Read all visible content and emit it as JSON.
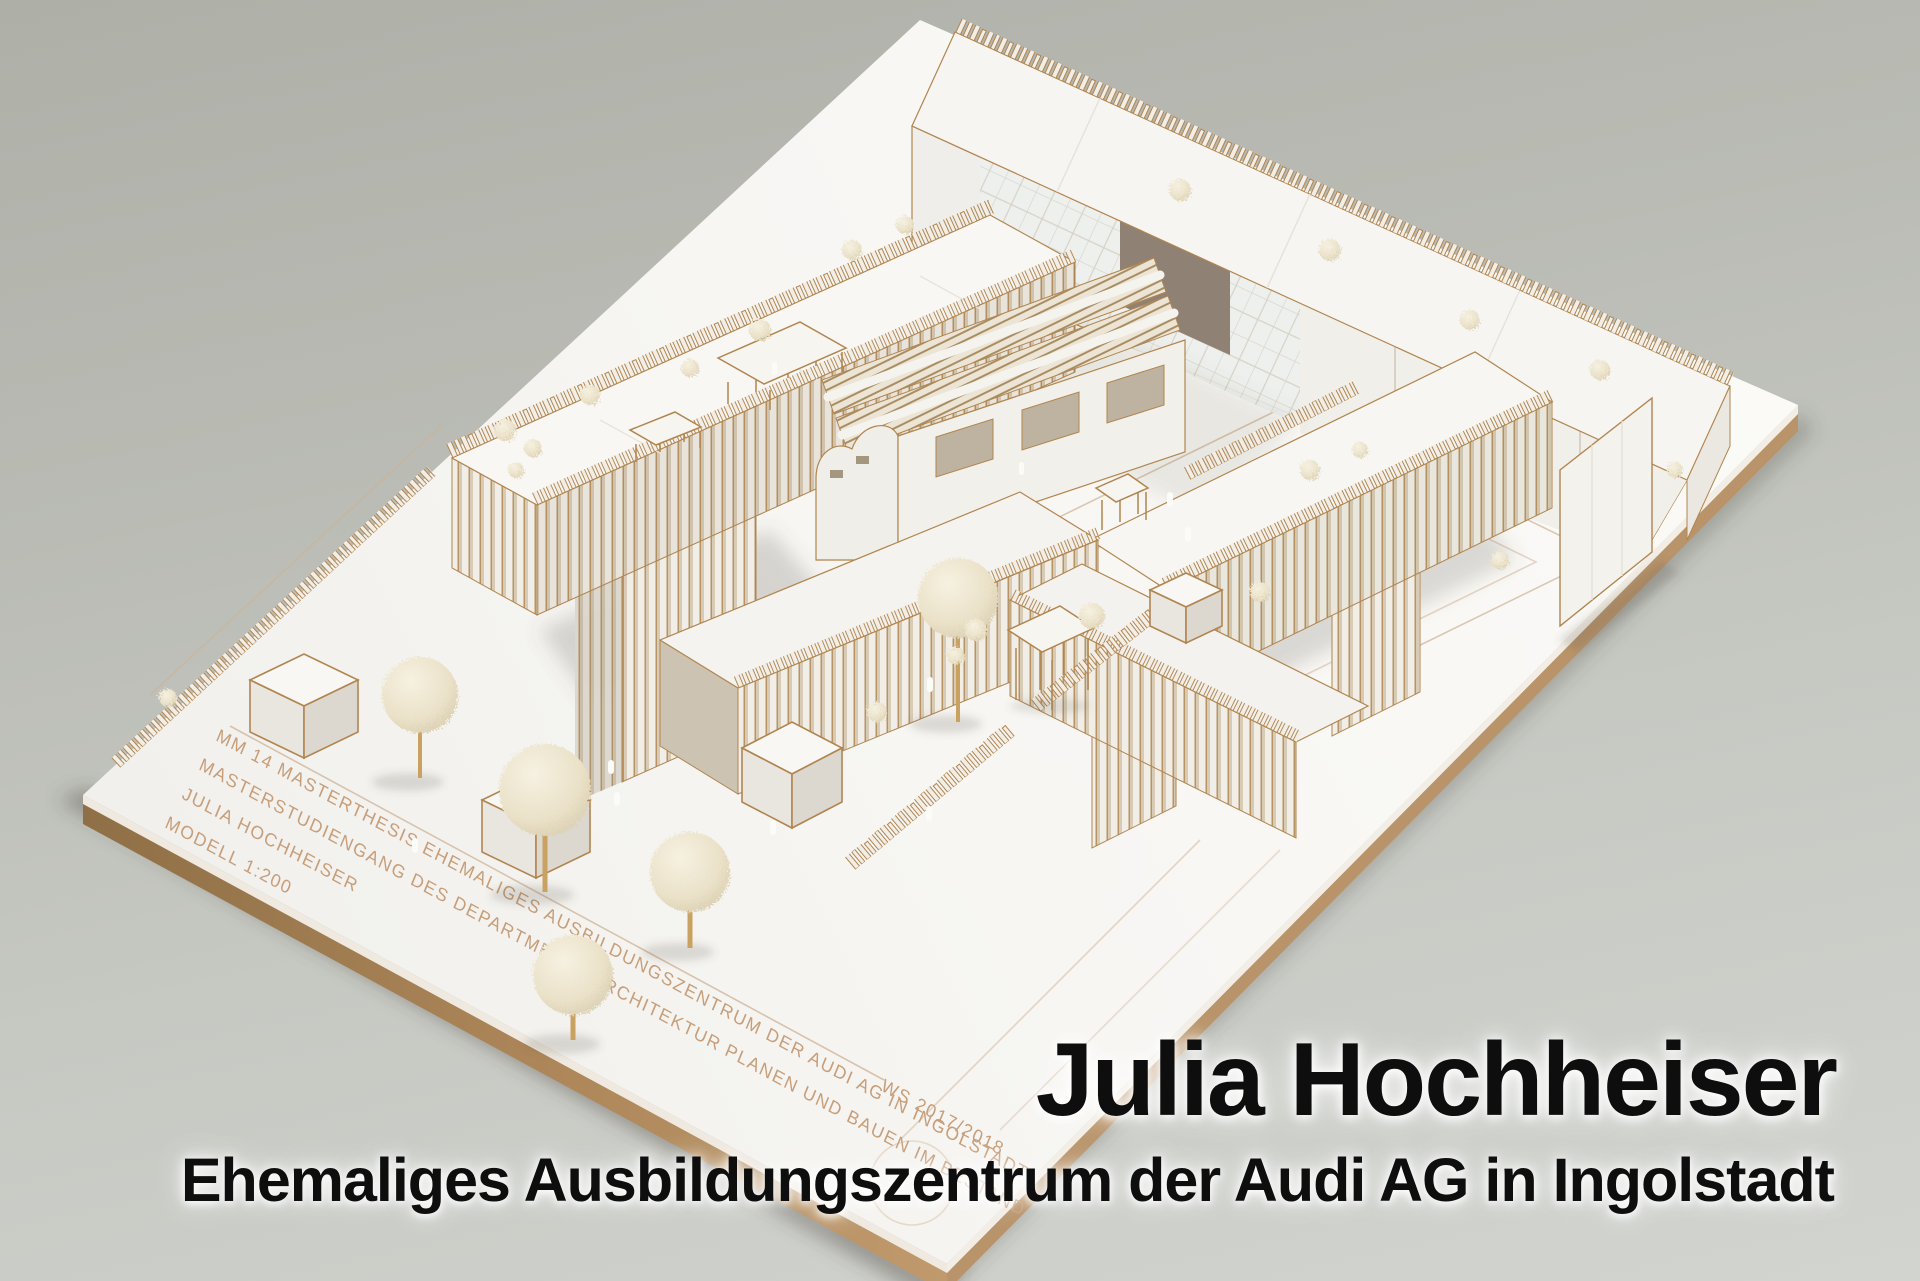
{
  "image": {
    "kind": "photograph",
    "subject": "white laser-cut architecture model of a training-centre campus on a plywood baseboard, photographed on a neutral grey studio background",
    "width_px": 1920,
    "height_px": 1281
  },
  "overlay": {
    "author_title": "Julia Hochheiser",
    "project_subtitle": "Ehemaliges Ausbildungszentrum der Audi AG in Ingolstadt"
  },
  "base_engraving": {
    "line_1": "MM 14 MASTERTHESIS  EHEMALIGES AUSBILDUNGSZENTRUM DER AUDI AG IN INGOLSTADT",
    "line_2": "MASTERSTUDIENGANG DES DEPARTMENTS ARCHITEKTUR  PLANEN UND BAUEN IM BESTAND",
    "line_3": "JULIA HOCHHEISER",
    "line_4": "MODELL 1:200",
    "term": "WS 2017/2018"
  },
  "colors": {
    "background_top": "#aeb0a8",
    "background_bottom": "#d2d4d0",
    "board_white": "#f6f5f2",
    "plywood_edge": "#a98355",
    "laser_cut_edge": "#b1854f",
    "engraving": "#c79e79",
    "slat_shadow": "#d5c8b2",
    "foliage": "#ece4cd",
    "overlay_text": "#0e0e0e",
    "overlay_glow": "#ffffff"
  }
}
